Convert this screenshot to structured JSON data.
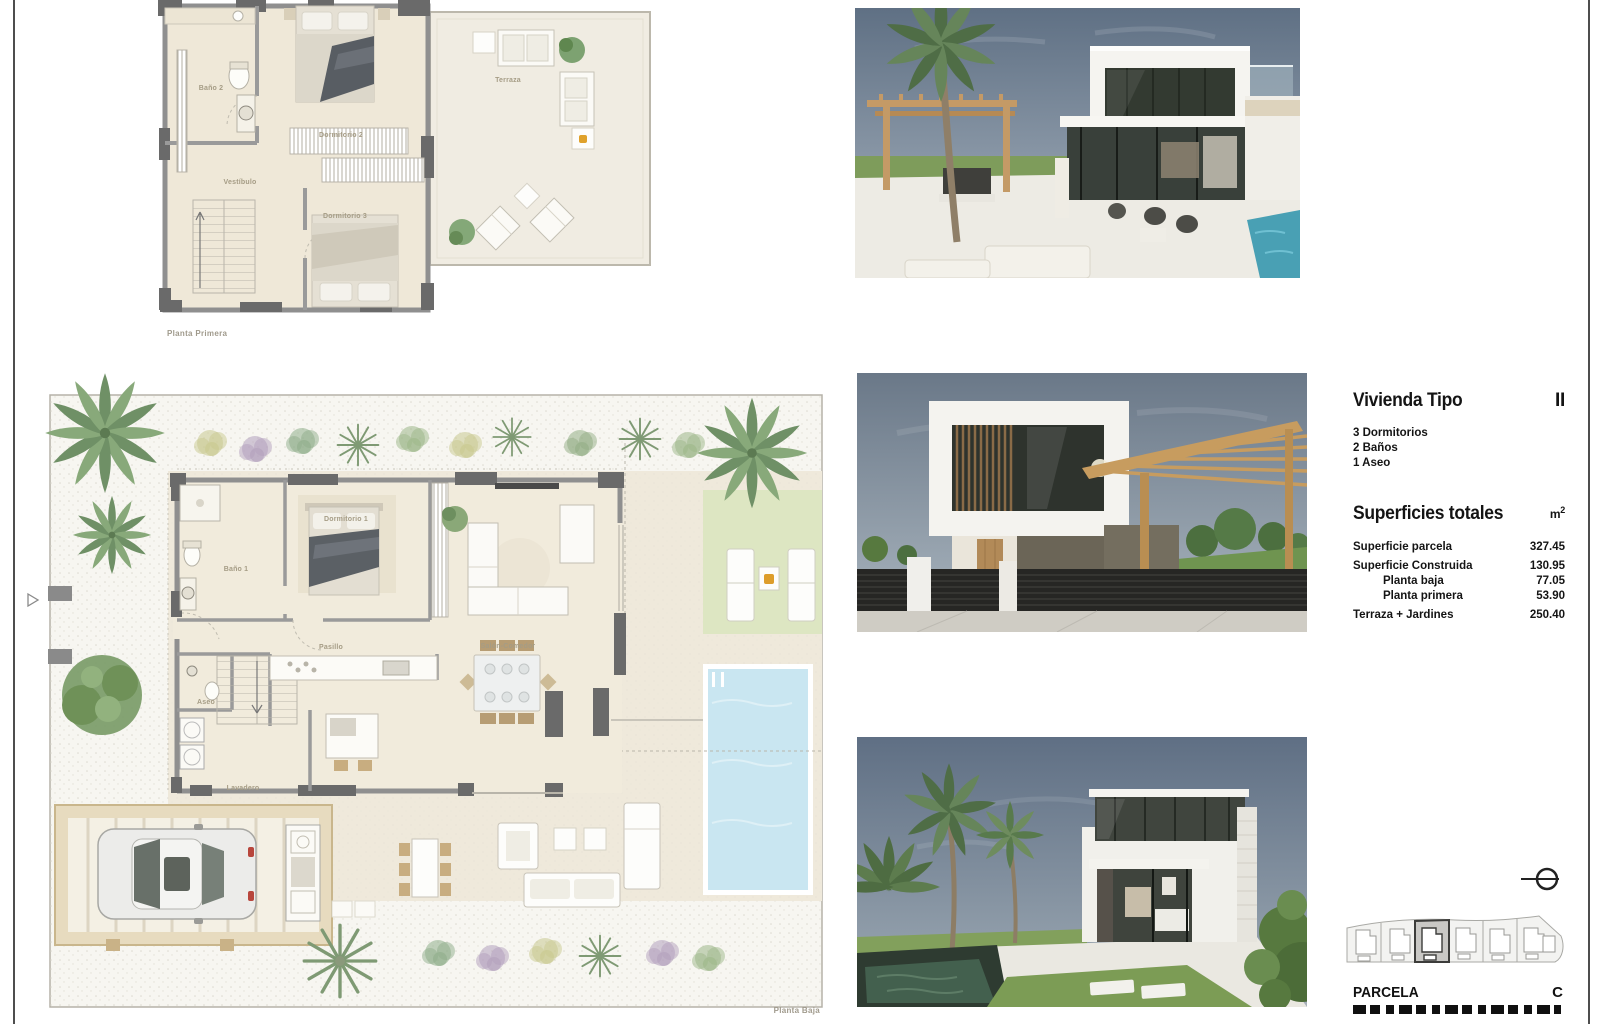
{
  "page": {
    "background": "#ffffff"
  },
  "plan_first": {
    "caption": "Planta Primera",
    "rooms": [
      {
        "label": "Baño 2"
      },
      {
        "label": "Dormitorio 2"
      },
      {
        "label": "Vestíbulo"
      },
      {
        "label": "Dormitorio 3"
      },
      {
        "label": "Terraza"
      }
    ]
  },
  "plan_ground": {
    "caption": "Planta Baja",
    "rooms": [
      {
        "label": "Dormitorio 1"
      },
      {
        "label": "Baño 1"
      },
      {
        "label": "Pasillo"
      },
      {
        "label": "Salón-Comedor"
      },
      {
        "label": "Aseo"
      },
      {
        "label": "Lavadero"
      }
    ]
  },
  "info": {
    "title": "Vivienda Tipo",
    "type_code": "II",
    "features": [
      "3 Dormitorios",
      "2 Baños",
      "1 Aseo"
    ],
    "surfaces_title": "Superficies totales",
    "unit_base": "m",
    "unit_sup": "2",
    "rows": [
      {
        "label": "Superficie parcela",
        "value": "327.45"
      },
      {
        "label": "Superficie Construida",
        "value": "130.95"
      },
      {
        "label": "Planta baja",
        "value": "77.05"
      },
      {
        "label": "Planta primera",
        "value": "53.90"
      },
      {
        "label": "Terraza + Jardines",
        "value": "250.40"
      }
    ]
  },
  "parcela": {
    "title": "PARCELA",
    "code": "C"
  },
  "icons": {
    "north_indicator": "⊖",
    "page_marker": "▷"
  },
  "colors": {
    "pool": "#c9e6f1",
    "lawn": "#dde6c2",
    "pergola_wood": "#c79c5f",
    "plot_highlight": "#c9c8c5",
    "accent_orange": "#dd9d2b"
  }
}
